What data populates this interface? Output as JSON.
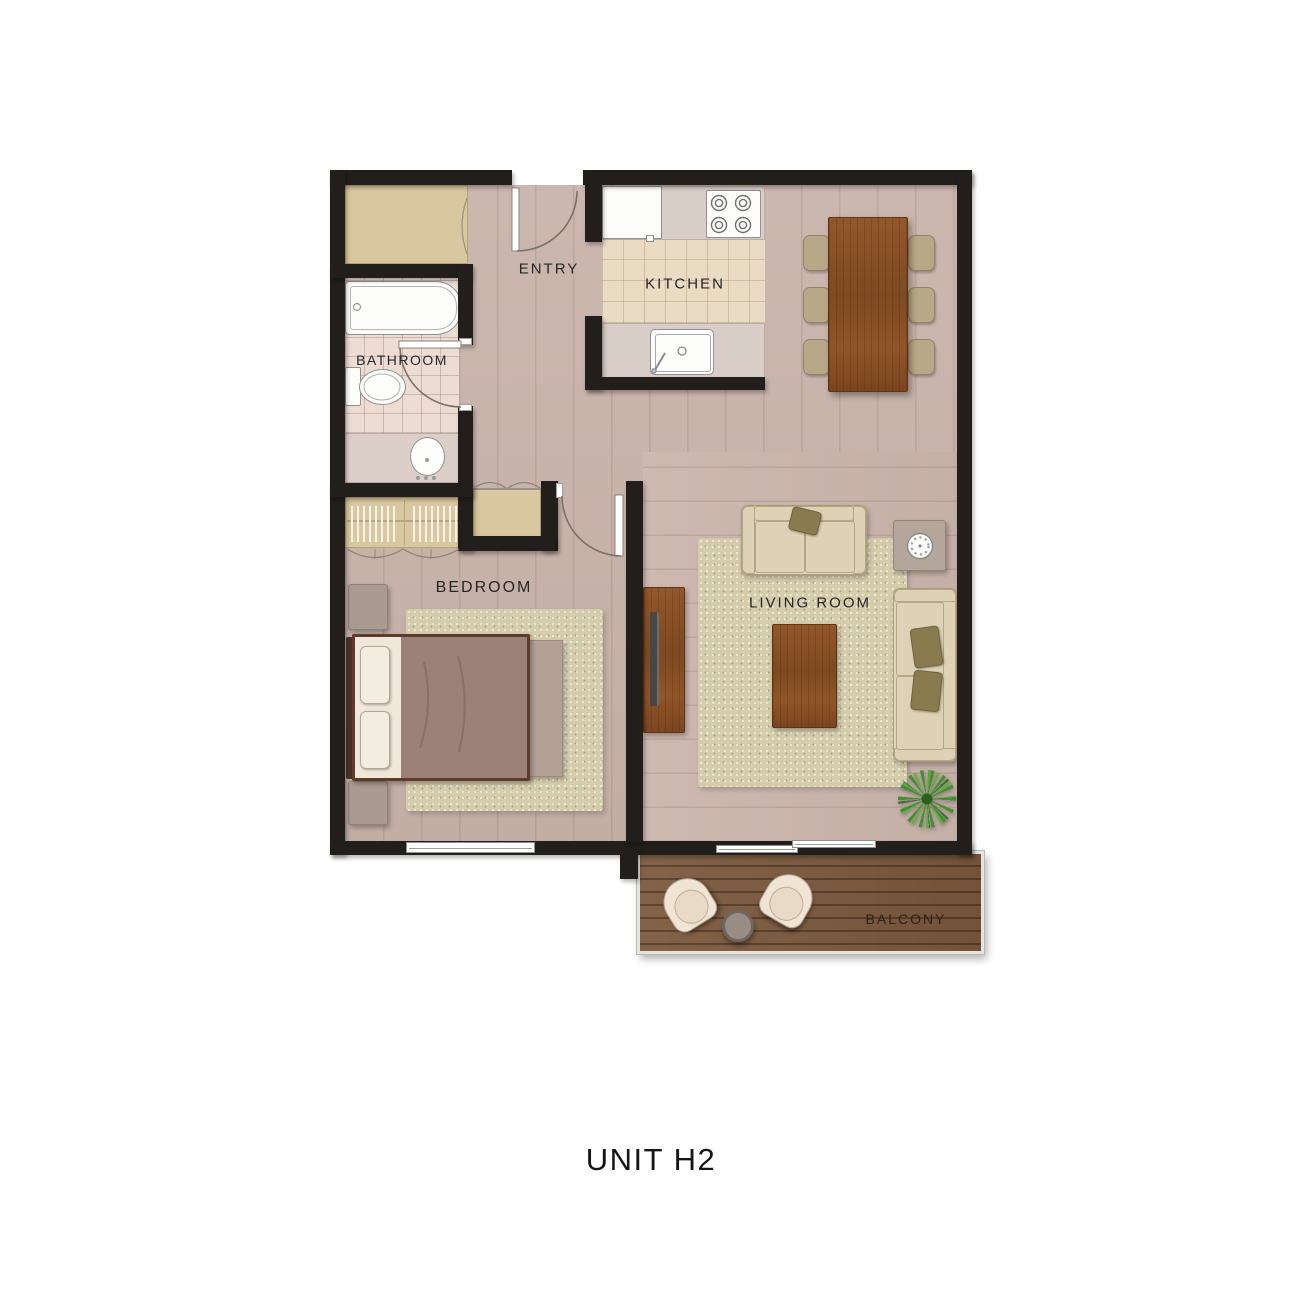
{
  "title": {
    "text": "UNIT H2"
  },
  "labels": {
    "entry": "ENTRY",
    "kitchen": "KITCHEN",
    "bathroom": "BATHROOM",
    "bedroom": "BEDROOM",
    "living_room": "LIVING ROOM",
    "balcony": "BALCONY"
  },
  "colors": {
    "wall": "#211e1b",
    "wood_floor": "#c9b3ab",
    "balcony_deck": "#7c5a3e",
    "closet_tan": "#d9c79f",
    "bathroom_tile": "#ecdcd4",
    "kitchen_tile": "#e9dbc4",
    "counter": "#d9cec7",
    "rug": "#d4ccab",
    "sofa": "#e0d6bc",
    "pillow_olive": "#8a7b4f",
    "wood_furniture": "#8a5126",
    "bed_blanket": "#9b8177",
    "plant_green": "#4e9b3c",
    "label_text": "#262626"
  }
}
